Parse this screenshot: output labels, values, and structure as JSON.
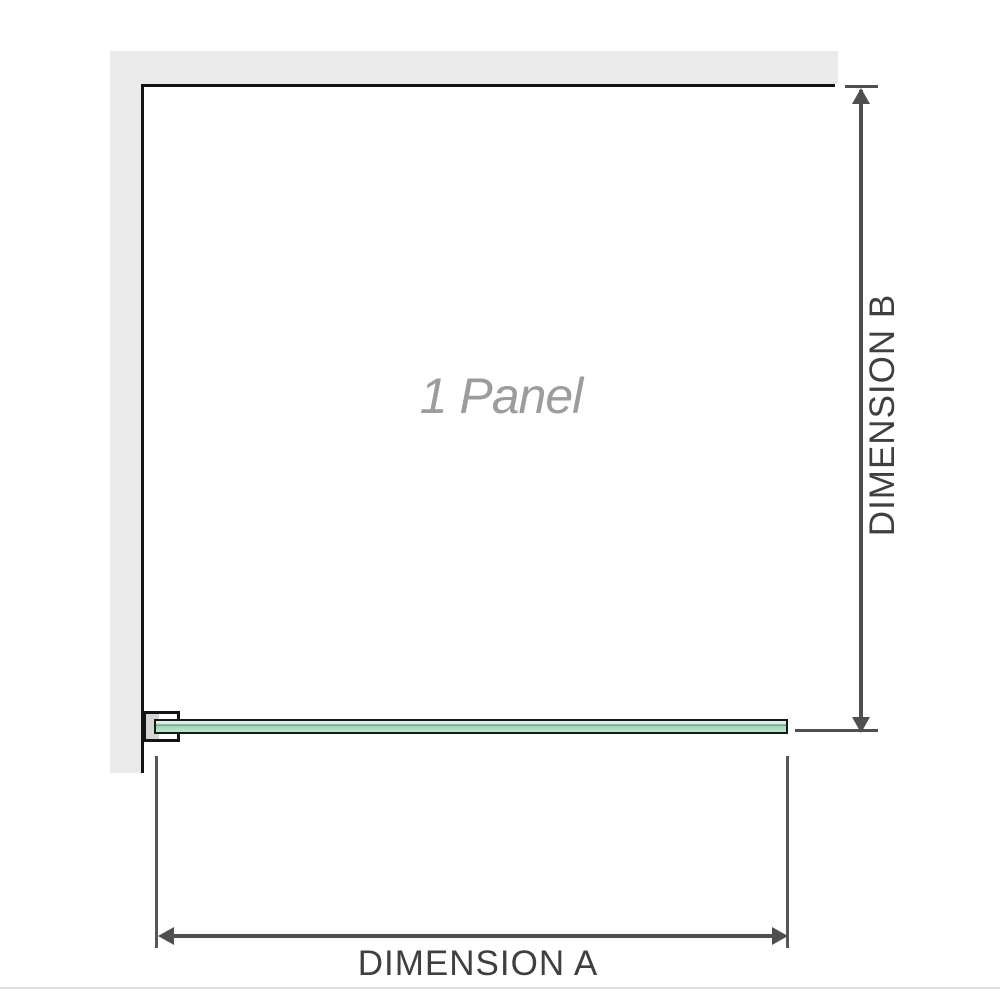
{
  "diagram": {
    "panel_label": "1 Panel",
    "dimension_a": {
      "label": "DIMENSION A",
      "orientation": "horizontal"
    },
    "dimension_b": {
      "label": "DIMENSION B",
      "orientation": "vertical"
    },
    "icons": {
      "arrow_up": "arrow-up-icon",
      "arrow_down": "arrow-down-icon",
      "arrow_left": "arrow-left-icon",
      "arrow_right": "arrow-right-icon"
    },
    "colors": {
      "background": "#ffffff",
      "wall_fill": "#eaeaea",
      "outline_black": "#141414",
      "dimension_line": "#4f4f4f",
      "dimension_text": "#3f3f3f",
      "panel_label_text": "#9c9c9c",
      "glass_fill": "#bfe5cf",
      "glass_fill_light": "#e7f4ed",
      "glass_accent_dark": "#5d8a77",
      "glass_border": "#101c14",
      "bracket_fill": "#d5d5d5",
      "bottom_rule": "#dfe3df"
    }
  }
}
